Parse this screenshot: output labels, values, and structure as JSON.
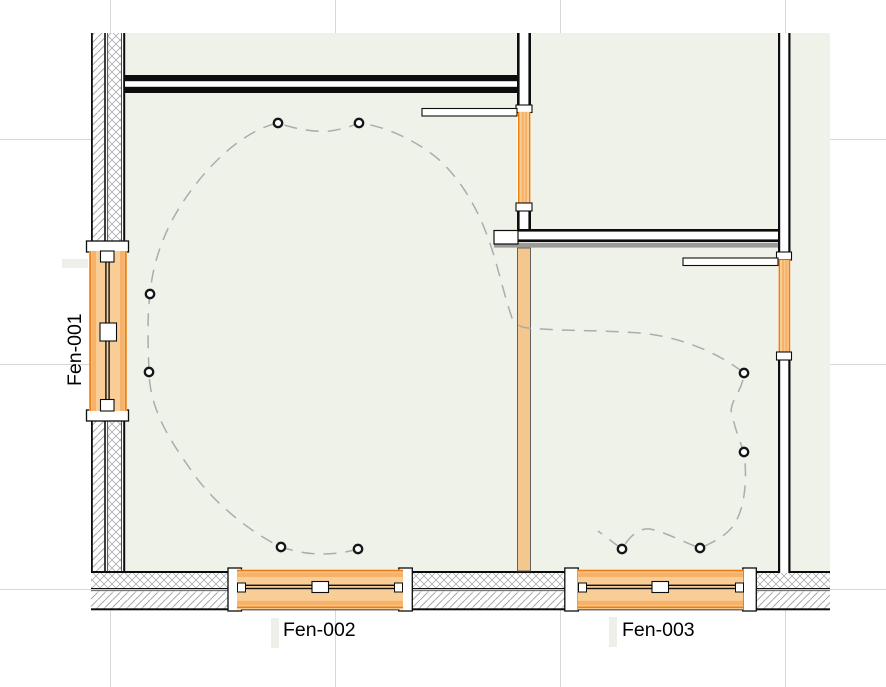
{
  "drawing": {
    "type": "floor-plan-crop",
    "labels": {
      "window1": "Fen-001",
      "window2": "Fen-002",
      "window3": "Fen-003"
    },
    "colors": {
      "room_fill": "#EFF2E9",
      "window_accent": "#EE7D0C",
      "window_fill": "#F8CD96",
      "window_inner_strip": "#F6B26A",
      "wall_orange_fill": "#F3C78D",
      "wall_line": "#0d0d0d",
      "hatch_gray": "#9C9C9C",
      "finish_stripe_gray": "#9A9A9A",
      "grid_gray": "#D7D7D3",
      "route_dash_gray": "#ACACAC"
    },
    "grid": {
      "vertical_x": [
        110.5,
        335.5,
        560.5,
        785.5
      ],
      "horizontal_y": [
        139.5,
        364.5,
        589.5
      ]
    },
    "route": {
      "dash_pattern": "13 9",
      "path": "M 358,549 Q 320,560 281,547 C 255,535 215,505 193,473 C 172,443 150,412 149,372 C 148,345 147,318 150,294 C 153,258 168,220 193,188 C 212,162 245,130 278,123 Q 307,133 330,131 Q 345,129 359,123 C 385,126 415,140 437,158 C 458,176 476,205 487,235 C 496,258 503,292 512,318 Q 517,327 528,328 C 560,331 600,330 640,333 C 675,336 715,350 744,373 C 742,392 733,396 731,410 Q 735,430 744,452 C 747,475 746,505 735,523 Q 727,537 700,548 C 685,543 668,533 650,529 Q 635,527 622,549 Q 610,540 598,531"
    },
    "markers": [
      [
        278,
        123
      ],
      [
        359,
        123
      ],
      [
        150,
        294
      ],
      [
        149,
        372
      ],
      [
        281,
        547
      ],
      [
        358,
        549
      ],
      [
        744,
        373
      ],
      [
        744,
        452
      ],
      [
        700,
        548
      ],
      [
        622,
        549
      ]
    ]
  }
}
